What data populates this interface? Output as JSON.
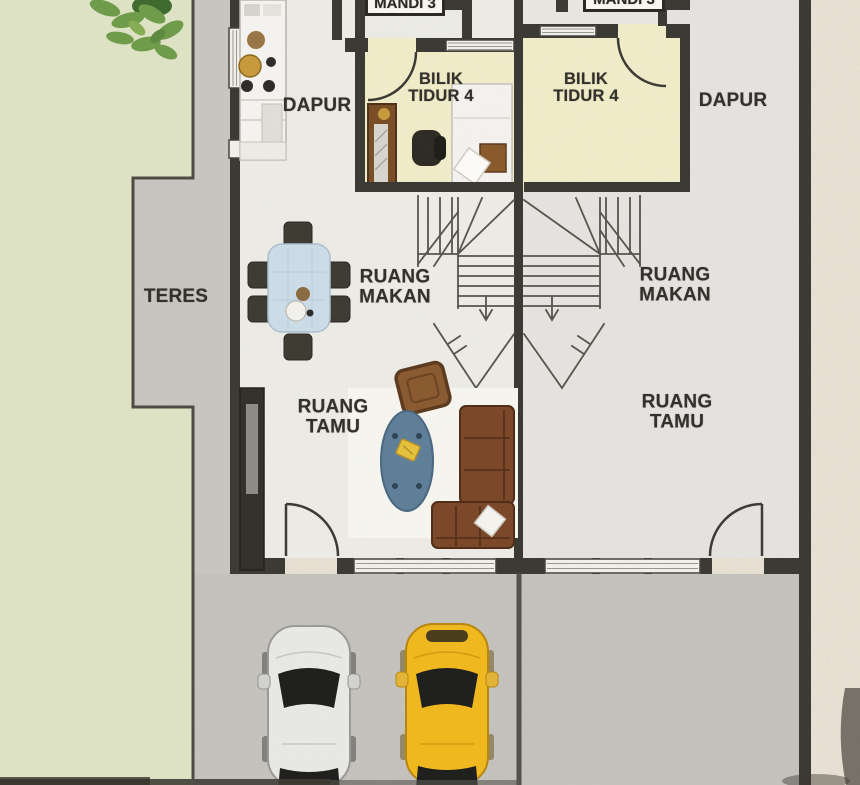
{
  "labels": {
    "left_unit": {
      "bathroom": "MANDI 3",
      "bedroom_line1": "BILIK",
      "bedroom_line2": "TIDUR 4",
      "kitchen": "DAPUR",
      "dining_line1": "RUANG",
      "dining_line2": "MAKAN",
      "living_line1": "RUANG",
      "living_line2": "TAMU"
    },
    "right_unit": {
      "bathroom": "MANDI 3",
      "bedroom_line1": "BILIK",
      "bedroom_line2": "TIDUR 4",
      "kitchen": "DAPUR",
      "dining_line1": "RUANG",
      "dining_line2": "MAKAN",
      "living_line1": "RUANG",
      "living_line2": "TAMU"
    },
    "outdoor": {
      "terrace": "TERES"
    }
  },
  "colors": {
    "paper_background": "#ece5d8",
    "lawn": "#dfe4c5",
    "terrace_path": "#c9c6c2",
    "driveway": "#c6c3bf",
    "floor_left_unit": "#edece7",
    "floor_right_unit": "#e6e4e0",
    "bedroom_floor": "#f1edc9",
    "wall": "#3b3933",
    "dining_table": "#ccdde9",
    "sofa": "#7b4728",
    "armchair": "#8a5a30",
    "oval_rug": "#5f7f99",
    "car_white": "#e9e9e7",
    "car_yellow": "#f2b91e",
    "tree_foliage": "#6f9c4a"
  }
}
